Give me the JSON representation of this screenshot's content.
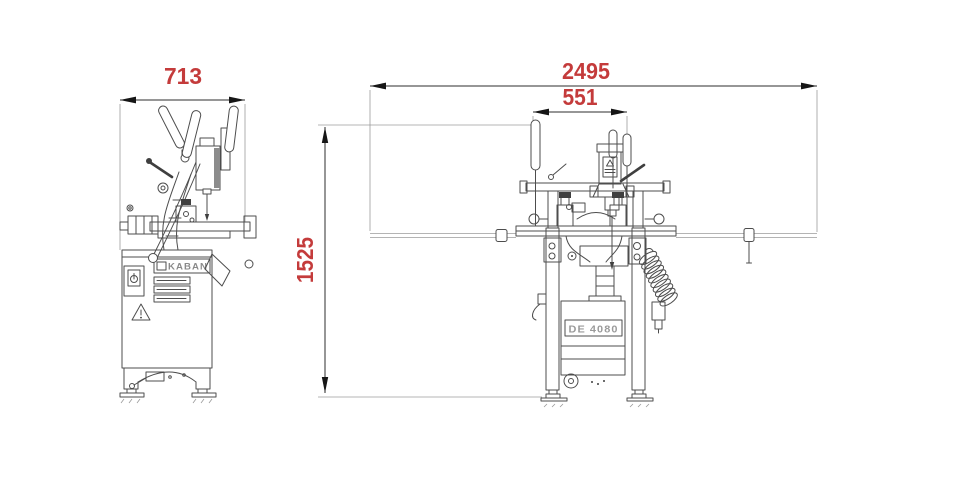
{
  "colors": {
    "dimension-text": "#c43b3b",
    "drawing-line": "#4d4d4d",
    "background": "#ffffff"
  },
  "drawing": {
    "side_view": {
      "width_dim": "713",
      "brand_plate": "KABAN"
    },
    "front_view": {
      "overall_width_dim": "2495",
      "inner_width_dim": "551",
      "height_dim": "1525",
      "model_plate": "DE 4080"
    }
  }
}
